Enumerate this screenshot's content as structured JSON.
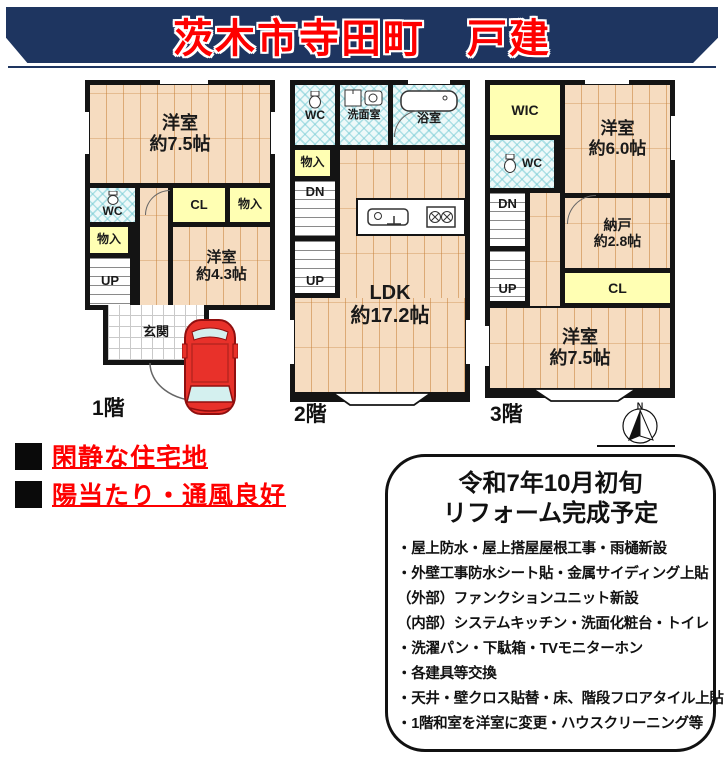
{
  "banner": {
    "title": "茨木市寺田町　戸建"
  },
  "colors": {
    "banner_navy": "#1e3560",
    "title_red": "#fe0000",
    "wood_floor": "#f6dcc0",
    "closet_yellow": "#ffffb3",
    "tile_cyan": "#eef9f9",
    "wall_black": "#141414",
    "car_red": "#e8312a"
  },
  "icons": {
    "car": "car-icon",
    "compass": "compass-icon",
    "toilet": "toilet-icon",
    "bathtub": "bathtub-icon",
    "sink": "sink-icon",
    "stove": "stove-icon",
    "washer": "washer-icon"
  },
  "floor1": {
    "label": "1階",
    "room_75": "洋室\n約7.5帖",
    "wc": "WC",
    "cl": "CL",
    "storage_right": "物入",
    "storage_left": "物入",
    "up": "UP",
    "room_43": "洋室\n約4.3帖",
    "genkan": "玄関"
  },
  "floor2": {
    "label": "2階",
    "wc": "WC",
    "senmen": "洗面室",
    "bath": "浴室",
    "storage": "物入",
    "dn": "DN",
    "up": "UP",
    "ldk": "LDK\n約17.2帖"
  },
  "floor3": {
    "label": "3階",
    "wic": "WIC",
    "room_60": "洋室\n約6.0帖",
    "wc": "WC",
    "dn": "DN",
    "up": "UP",
    "nando": "納戸\n約2.8帖",
    "cl": "CL",
    "room_75": "洋室\n約7.5帖",
    "compass_north": "N"
  },
  "features": [
    "閑静な住宅地",
    "陽当たり・通風良好"
  ],
  "info_box": {
    "title_line1": "令和7年10月初旬",
    "title_line2": "リフォーム完成予定",
    "items": [
      "・屋上防水・屋上搭屋屋根工事・雨樋新設",
      "・外壁工事防水シート貼・金属サイディング上貼",
      "（外部）ファンクションユニット新設",
      "（内部）システムキッチン・洗面化粧台・トイレ",
      "・洗濯パン・下駄箱・TVモニターホン",
      "・各建具等交換",
      "・天井・壁クロス貼替・床、階段フロアタイル上貼",
      "・1階和室を洋室に変更・ハウスクリーニング等"
    ]
  }
}
